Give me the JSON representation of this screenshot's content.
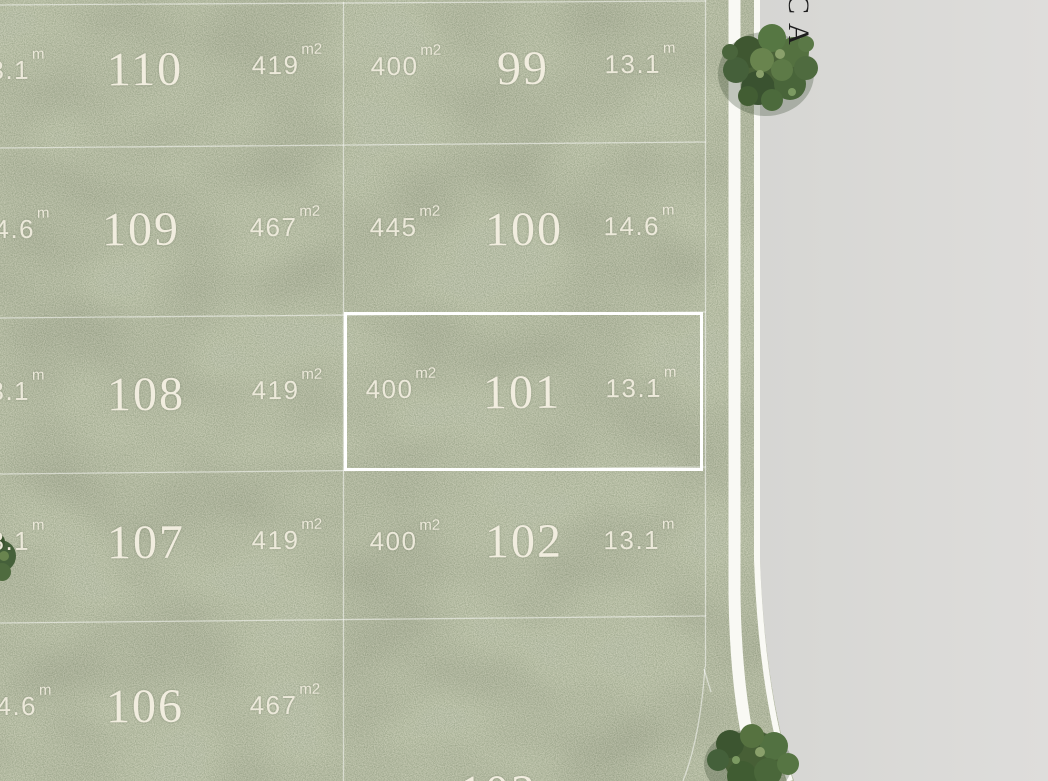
{
  "scene": {
    "type": "aerial land subdivision masterplan",
    "street_label": "CA",
    "colors": {
      "grass_base": "#78815f",
      "grass_light": "#929a77",
      "grass_dark": "#5c6747",
      "road_pavement": "#dbdad7",
      "path_white": "#f9f9f4",
      "boundary_line": "#ffffff",
      "highlight_outline": "#ffffff",
      "label_text": "#ece9da",
      "lot_number_text": "#f1eddf",
      "street_text": "#1d1d1d",
      "tree_dark": "#3c5230",
      "tree_mid": "#55703f",
      "tree_light": "#7c9a62"
    }
  },
  "lots": [
    {
      "number": "110",
      "area_value": "419",
      "area_unit": "m2",
      "frontage_value": "13.1",
      "frontage_unit": "m",
      "highlighted": false
    },
    {
      "number": "99",
      "area_value": "400",
      "area_unit": "m2",
      "frontage_value": "13.1",
      "frontage_unit": "m",
      "highlighted": false
    },
    {
      "number": "109",
      "area_value": "467",
      "area_unit": "m2",
      "frontage_value": "14.6",
      "frontage_unit": "m",
      "highlighted": false
    },
    {
      "number": "100",
      "area_value": "445",
      "area_unit": "m2",
      "frontage_value": "14.6",
      "frontage_unit": "m",
      "highlighted": false
    },
    {
      "number": "108",
      "area_value": "419",
      "area_unit": "m2",
      "frontage_value": "13.1",
      "frontage_unit": "m",
      "highlighted": false
    },
    {
      "number": "101",
      "area_value": "400",
      "area_unit": "m2",
      "frontage_value": "13.1",
      "frontage_unit": "m",
      "highlighted": true
    },
    {
      "number": "107",
      "area_value": "419",
      "area_unit": "m2",
      "frontage_value": "13.1",
      "frontage_unit": "m",
      "highlighted": false
    },
    {
      "number": "102",
      "area_value": "400",
      "area_unit": "m2",
      "frontage_value": "13.1",
      "frontage_unit": "m",
      "highlighted": false
    },
    {
      "number": "106",
      "area_value": "467",
      "area_unit": "m2",
      "frontage_value": "14.6",
      "frontage_unit": "m",
      "highlighted": false
    },
    {
      "number": "103",
      "highlighted": false
    }
  ]
}
